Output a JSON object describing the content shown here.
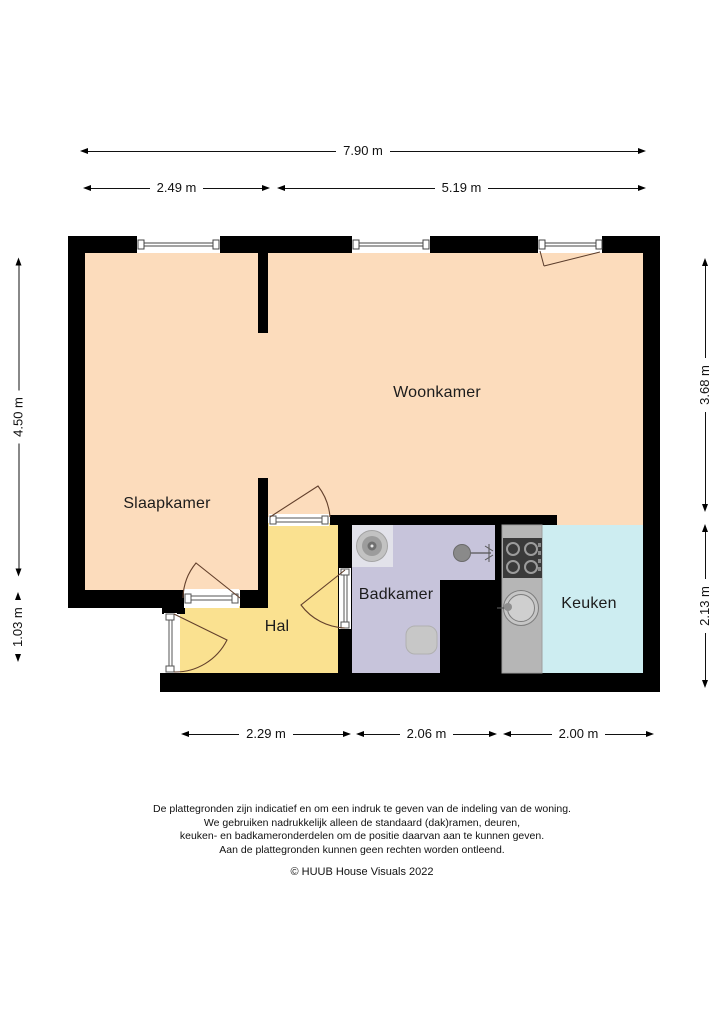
{
  "floorplan": {
    "wall_color": "#000000",
    "door_arc_color": "#63402c",
    "rooms": [
      {
        "id": "slaapkamer",
        "label": "Slaapkamer",
        "color": "#fcdcbc"
      },
      {
        "id": "woonkamer",
        "label": "Woonkamer",
        "color": "#fcdcbc"
      },
      {
        "id": "hal",
        "label": "Hal",
        "color": "#fae190"
      },
      {
        "id": "badkamer",
        "label": "Badkamer",
        "color": "#c7c4db"
      },
      {
        "id": "keuken",
        "label": "Keuken",
        "color": "#cdedf1"
      }
    ],
    "fixture_colors": {
      "counter": "#b6b6b6",
      "stove": "#3a3a3a",
      "fixture_gray": "#c7c7c7"
    }
  },
  "dimensions": {
    "top_total": "7.90 m",
    "top_left": "2.49 m",
    "top_right": "5.19 m",
    "left_upper": "4.50 m",
    "left_lower": "1.03 m",
    "right_upper": "3.68 m",
    "right_lower": "2.13 m",
    "bottom_left": "2.29 m",
    "bottom_middle": "2.06 m",
    "bottom_right": "2.00 m"
  },
  "footer": {
    "disclaimer_lines": [
      "De plattegronden zijn indicatief en om een indruk te geven van de indeling van de woning.",
      "We gebruiken nadrukkelijk alleen de standaard (dak)ramen, deuren,",
      "keuken- en badkameronderdelen om de positie daarvan aan te kunnen geven.",
      "Aan de plattegronden kunnen geen rechten worden ontleend."
    ],
    "copyright": "© HUUB House Visuals 2022"
  }
}
